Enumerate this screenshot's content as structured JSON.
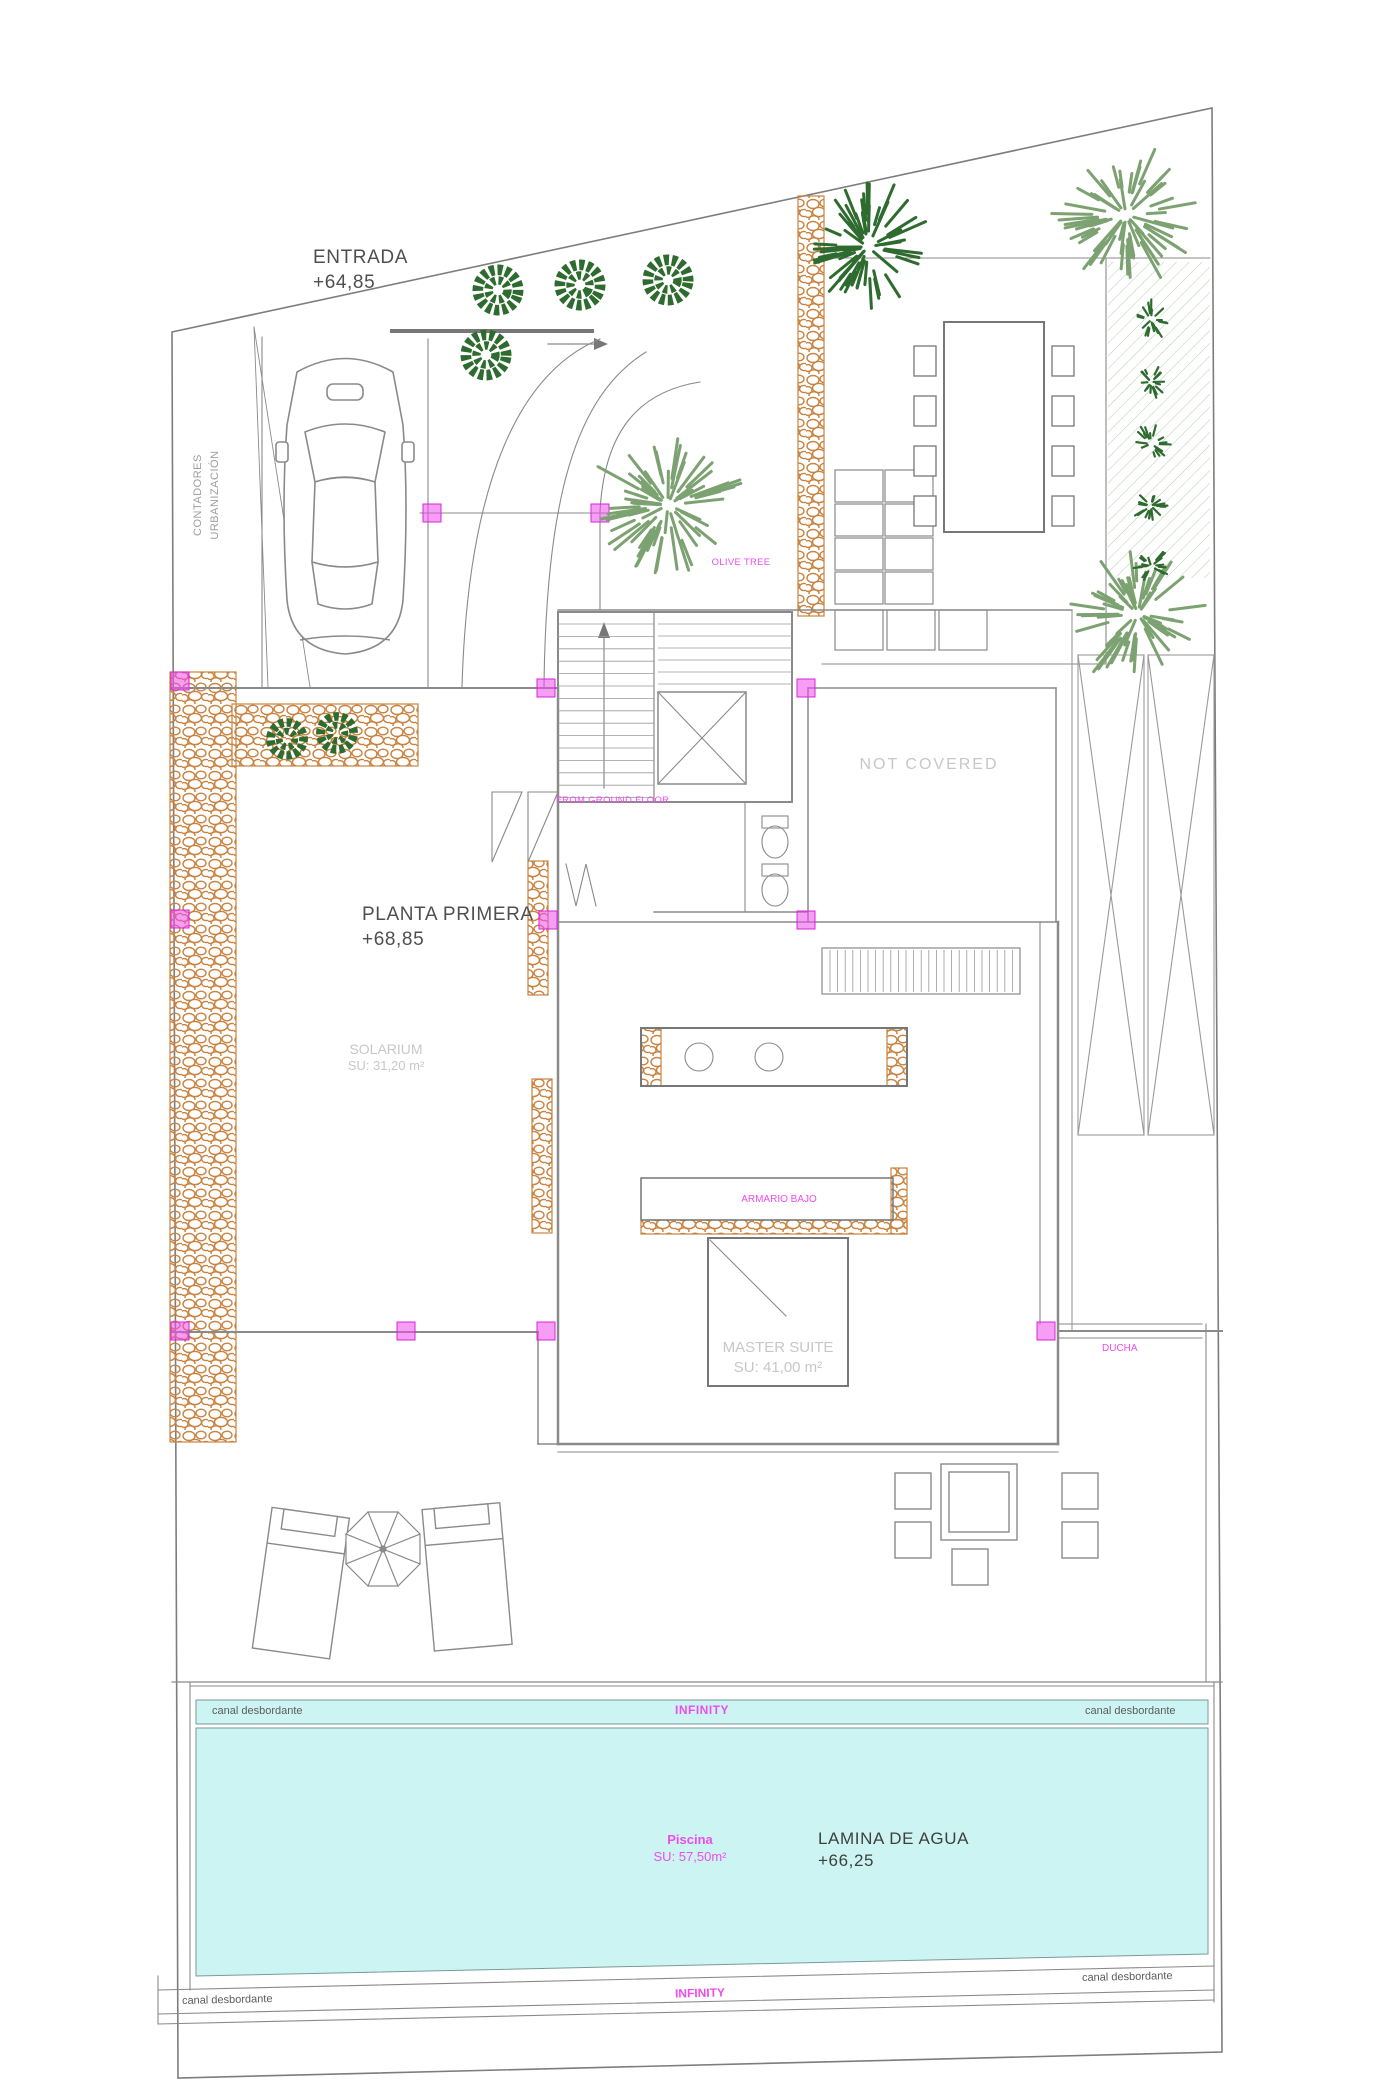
{
  "labels": {
    "entrada_name": "ENTRADA",
    "entrada_level": "+64,85",
    "contadores_line1": "CONTADORES",
    "contadores_line2": "URBANIZACIÓN",
    "olive_tree": "OLIVE TREE",
    "not_covered": "NOT COVERED",
    "planta_name": "PLANTA PRIMERA",
    "planta_level": "+68,85",
    "ground_floor_note": "FROM GROUND FLOOR",
    "solarium_name": "SOLARIUM",
    "solarium_area": "SU: 31,20 m²",
    "armario_bajo": "ARMARIO BAJO",
    "master_suite_name": "MASTER SUITE",
    "master_suite_area": "SU: 41,00 m²",
    "ducha": "DUCHA"
  },
  "pool": {
    "canal_top_left": "canal desbordante",
    "canal_top_right": "canal desbordante",
    "canal_bottom_left": "canal desbordante",
    "canal_bottom_right": "canal desbordante",
    "infinity_top": "INFINITY",
    "infinity_bottom": "INFINITY",
    "piscina_name": "Piscina",
    "piscina_area": "SU: 57,50m²",
    "lamina_name": "LAMINA DE AGUA",
    "lamina_level": "+66,25"
  },
  "colors": {
    "annotation_magenta": "#ee4dee",
    "pebble_orange": "#c9823f",
    "pool_cyan": "#ccf4f2",
    "tree_dark_green": "#2e6b2e",
    "tree_sage_green": "#7da271",
    "line_gray": "#8a8a8a"
  }
}
